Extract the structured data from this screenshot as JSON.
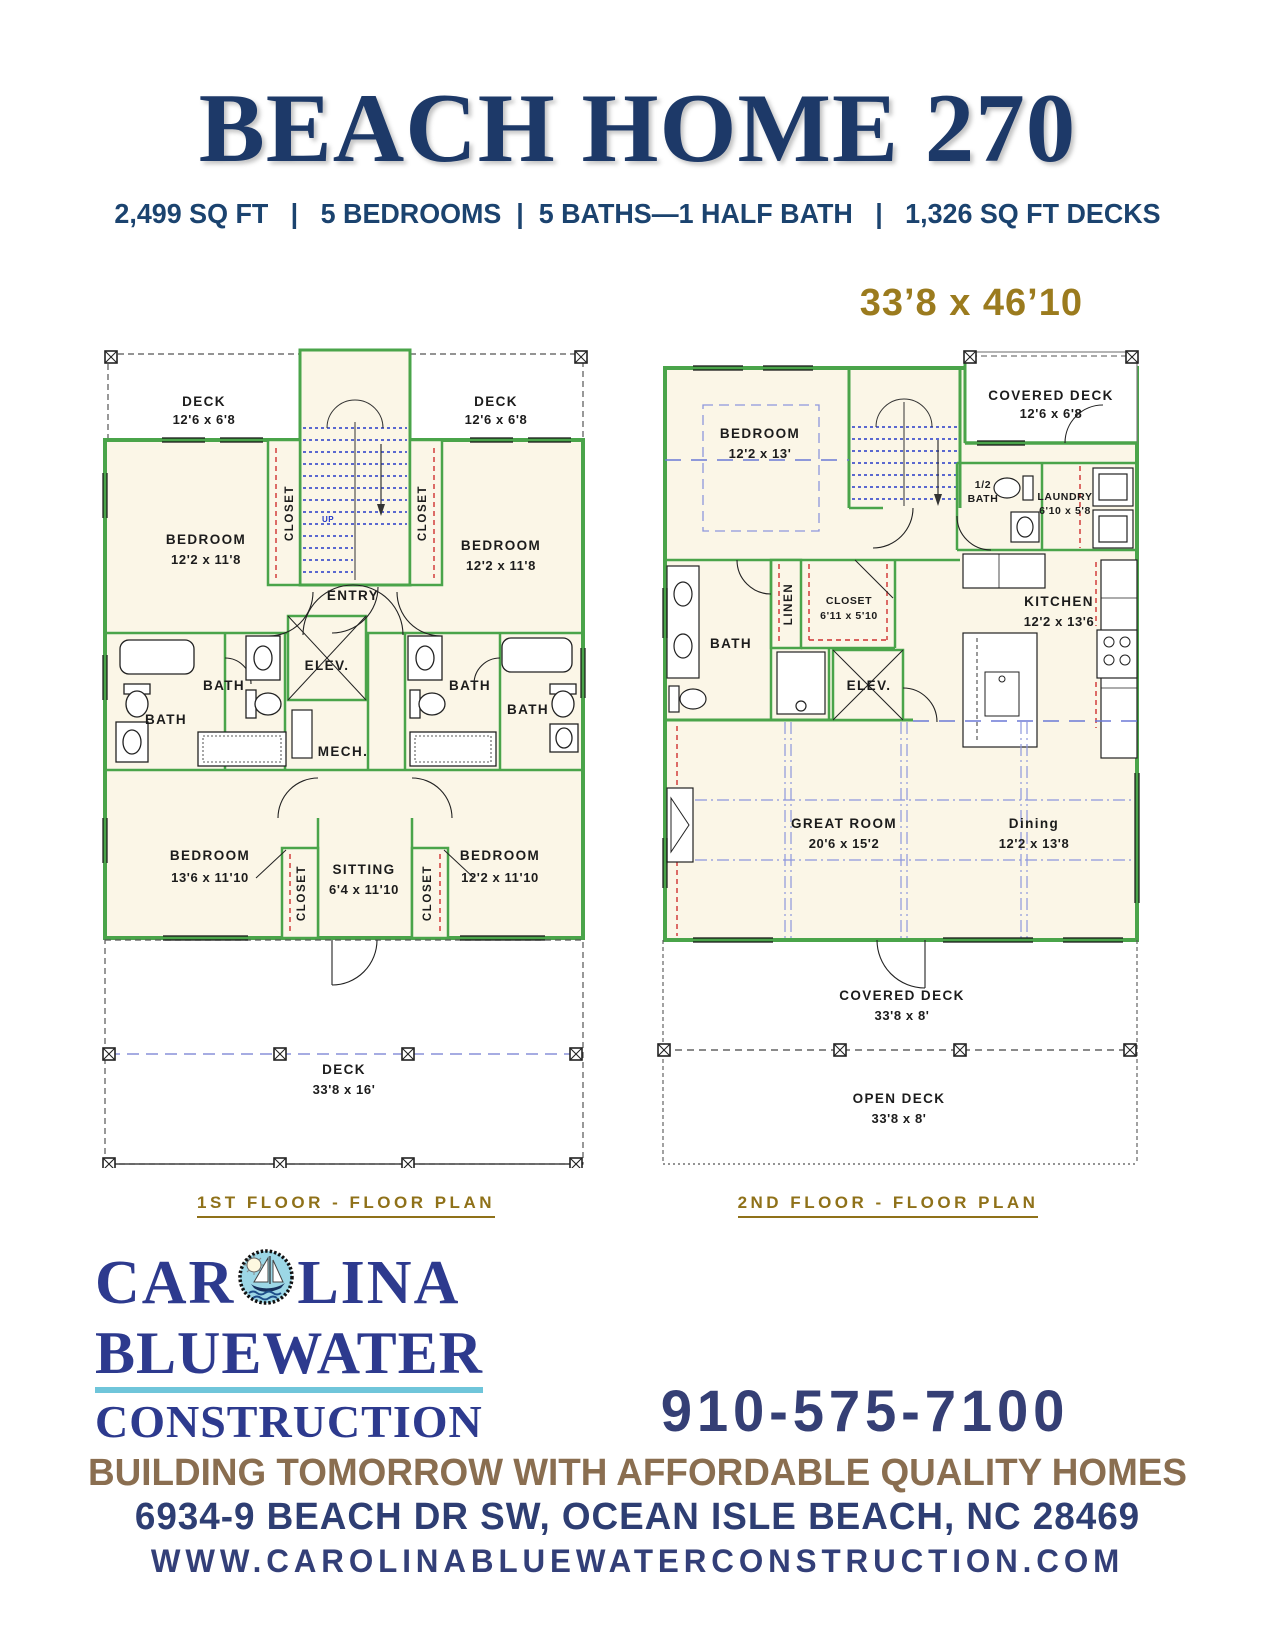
{
  "page": {
    "title": "BEACH HOME 270",
    "stats": "2,499 SQ FT   |   5 BEDROOMS  |  5 BATHS—1 HALF BATH   |   1,326 SQ FT DECKS",
    "overall_dims": "33’8 x 46’10"
  },
  "plan1": {
    "caption": "1ST FLOOR - FLOOR PLAN",
    "labels": {
      "deck_left": {
        "l1": "DECK",
        "l2": "12'6 x 6'8"
      },
      "deck_right": {
        "l1": "DECK",
        "l2": "12'6 x 6'8"
      },
      "closet_tl": "CLOSET",
      "closet_tr": "CLOSET",
      "bedroom_tl": {
        "l1": "BEDROOM",
        "l2": "12'2 x 11'8"
      },
      "bedroom_tr": {
        "l1": "BEDROOM",
        "l2": "12'2 x 11'8"
      },
      "entry": "ENTRY",
      "up": "UP",
      "bath_far_left": "BATH",
      "bath_mid_left": "BATH",
      "elev": "ELEV.",
      "mech": "MECH.",
      "bath_mid_right": "BATH",
      "bath_far_right": "BATH",
      "bedroom_bl": {
        "l1": "BEDROOM",
        "l2": "13'6 x 11'10"
      },
      "sitting": {
        "l1": "SITTING",
        "l2": "6'4 x 11'10"
      },
      "bedroom_br": {
        "l1": "BEDROOM",
        "l2": "12'2 x 11'10"
      },
      "closet_bl": "CLOSET",
      "closet_br": "CLOSET",
      "deck_bottom": {
        "l1": "DECK",
        "l2": "33'8 x 16'"
      }
    }
  },
  "plan2": {
    "caption": "2ND FLOOR - FLOOR PLAN",
    "labels": {
      "bedroom": {
        "l1": "BEDROOM",
        "l2": "12'2 x 13'"
      },
      "covered_deck_top": {
        "l1": "COVERED DECK",
        "l2": "12'6 x 6'8"
      },
      "half_bath": {
        "l1": "1/2",
        "l2": "BATH"
      },
      "laundry": {
        "l1": "LAUNDRY",
        "l2": "6'10 x 5'8"
      },
      "linen": "LINEN",
      "closet": {
        "l1": "CLOSET",
        "l2": "6'11 x 5'10"
      },
      "bath": "BATH",
      "elev": "ELEV.",
      "kitchen": {
        "l1": "KITCHEN",
        "l2": "12'2 x 13'6"
      },
      "great_room": {
        "l1": "GREAT ROOM",
        "l2": "20'6 x 15'2"
      },
      "dining": {
        "l1": "Dining",
        "l2": "12'2 x 13'8"
      },
      "covered_deck_bottom": {
        "l1": "COVERED DECK",
        "l2": "33'8 x 8'"
      },
      "open_deck": {
        "l1": "OPEN DECK",
        "l2": "33'8 x 8'"
      }
    }
  },
  "footer": {
    "logo": {
      "part1": "CAR",
      "part2": "LINA",
      "line2": "BLUEWATER",
      "line3": "CONSTRUCTION",
      "badge_icon": "sun-sailboat-badge"
    },
    "phone": "910-575-7100",
    "slogan": "BUILDING TOMORROW WITH AFFORDABLE QUALITY HOMES",
    "address": "6934-9 BEACH DR SW, OCEAN ISLE BEACH, NC 28469",
    "website": "WWW.CAROLINABLUEWATERCONSTRUCTION.COM"
  },
  "colors": {
    "title_navy": "#1d3968",
    "stats_navy": "#1b436f",
    "gold": "#9b7b1e",
    "caption_gold": "#8f7119",
    "logo_navy": "#2d3a8e",
    "logo_underline_blue": "#6fc5da",
    "slogan_brown": "#8a6e50",
    "wall_green": "#4aa44a",
    "floor_cream": "#fbf6e7",
    "stair_blue": "#2438c8",
    "rod_red": "#d03030",
    "grid_lavender": "#8d97dd"
  }
}
